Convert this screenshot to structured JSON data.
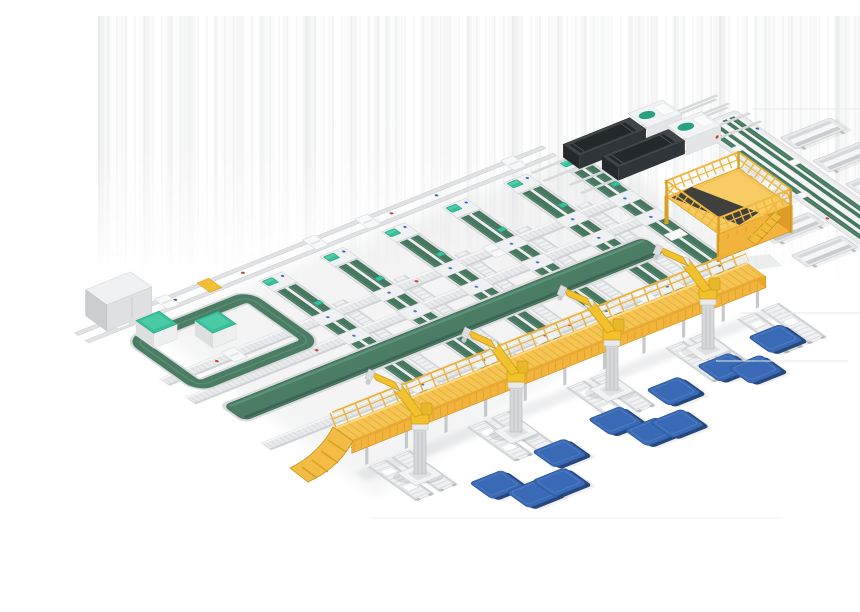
{
  "meta": {
    "title": "Automated conveyor sorting and palletizing system",
    "description": "Isometric 3D render of an automated logistics line: six green belt sorter lanes crossed by roller rails, an infeed loop with electrical cabinet and two teal stations, two dark labeling machines, a multi-belt outfeed spine with side tables, a yellow maintenance platform with stairs, a long elevated yellow walkway with access ramp, white discharge chutes, four yellow palletizing robot arms and eleven blue pallets on a white studio background."
  },
  "palette": {
    "bg": "#ffffff",
    "belt_green": "#46775f",
    "belt_green_dark": "#2f5447",
    "belt_band": "#4b7d65",
    "belt_sheen": "#6aa287",
    "frame_silver": "#dfe1e2",
    "frame_stroke": "#c2c6c8",
    "white_top": "#f0f1f2",
    "steel": "#d4d7d9",
    "teal": "#38c09b",
    "teal_dark": "#22a17e",
    "machine_dark": "#3f4549",
    "machine_panel": "#23282b",
    "yellow_deck": "#f6c453",
    "yellow_face": "#f2b43d",
    "yellow_dark": "#da9f27",
    "yellow_outline": "#cf8f1e",
    "robot_yellow": "#f2c12e",
    "robot_outline": "#cf9c15",
    "pallet_blue": "#3a6ab5",
    "pallet_edge": "#26477c",
    "pallet_stroke": "#2c5597",
    "accent_red": "#d04038",
    "accent_blue": "#2e5fbf",
    "shadow": "#8a9096"
  },
  "scene": {
    "sorter_lanes": 6,
    "roller_return_lanes": 5,
    "cross_rails": 3,
    "infeed_rails": 2,
    "wide_transfer_belts": 1,
    "labeling_machines": 2,
    "teal_stations": 2,
    "electrical_cabinets": 1,
    "outfeed_spine_belts": 4,
    "side_tables_left": 4,
    "side_tables_right": 4,
    "work_platforms": 1,
    "elevated_walkways": 1,
    "access_ramps": 1,
    "discharge_chute_pairs": 5,
    "palletizing_robots": 4,
    "pallets": 11
  }
}
